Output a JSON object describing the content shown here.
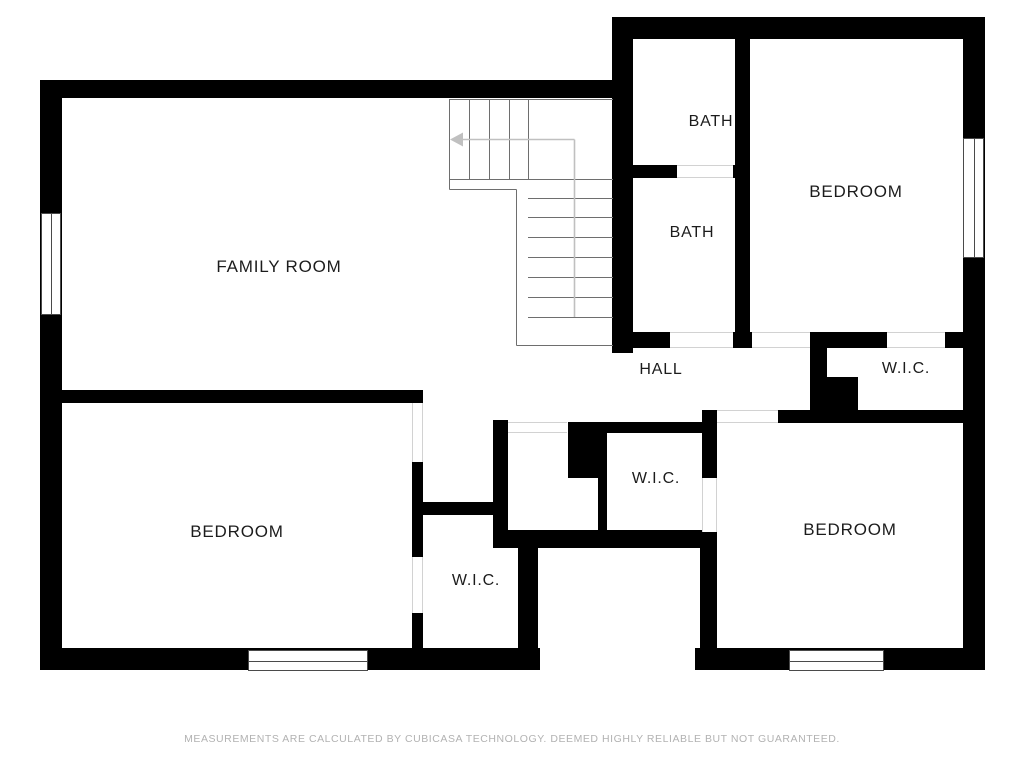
{
  "floorplan": {
    "rooms": [
      {
        "id": "family-room",
        "label": "FAMILY ROOM"
      },
      {
        "id": "bath-upper",
        "label": "BATH"
      },
      {
        "id": "bath-lower",
        "label": "BATH"
      },
      {
        "id": "bedroom-top-right",
        "label": "BEDROOM"
      },
      {
        "id": "wic-top-right",
        "label": "W.I.C."
      },
      {
        "id": "hall",
        "label": "HALL"
      },
      {
        "id": "wic-center",
        "label": "W.I.C."
      },
      {
        "id": "wic-bottom-left",
        "label": "W.I.C."
      },
      {
        "id": "bedroom-bottom-left",
        "label": "BEDROOM"
      },
      {
        "id": "bedroom-bottom-right",
        "label": "BEDROOM"
      }
    ],
    "footer": "MEASUREMENTS ARE CALCULATED BY CUBICASA TECHNOLOGY. DEEMED HIGHLY RELIABLE BUT NOT GUARANTEED.",
    "colors": {
      "background": "#ffffff",
      "wall": "#000000",
      "label": "#1c1c1c",
      "footer": "#b2b2b2",
      "stair_line": "#6e6e6e",
      "walk_line": "#c0c0c0",
      "opening_line": "#d2d2d2",
      "window_frame": "#4a4a4a"
    }
  }
}
